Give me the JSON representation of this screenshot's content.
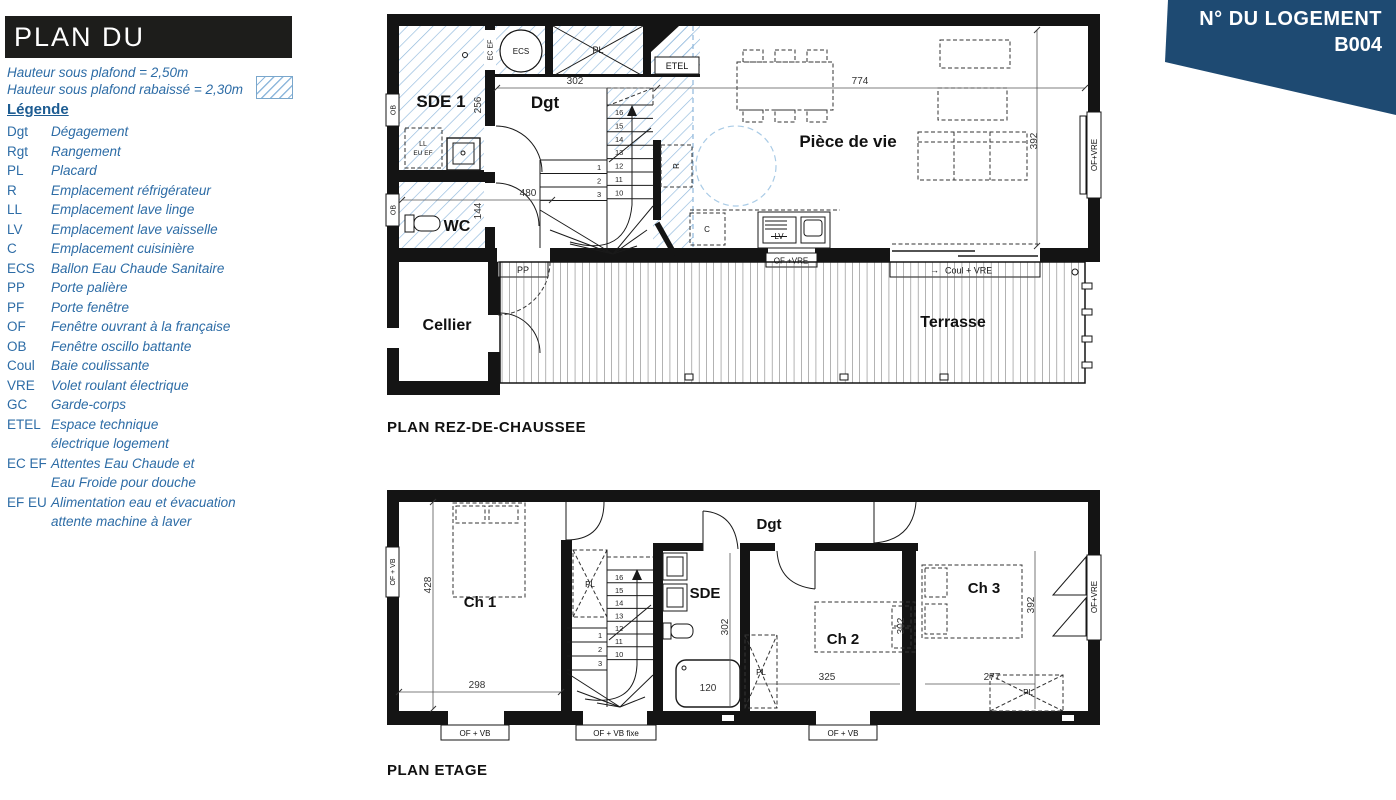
{
  "colors": {
    "accent_blue": "#2d6ca6",
    "badge_navy": "#1e4a72",
    "hatch_blue": "#8fb8dc",
    "wall_black": "#141414"
  },
  "header": {
    "title": "PLAN DU LOGEMENT",
    "ceiling_note_1": "Hauteur sous plafond = 2,50m",
    "ceiling_note_2": "Hauteur sous plafond rabaissé = 2,30m",
    "legend_title": "Légende",
    "legend": [
      {
        "abbr": "Dgt",
        "label": "Dégagement"
      },
      {
        "abbr": "Rgt",
        "label": "Rangement"
      },
      {
        "abbr": "PL",
        "label": "Placard"
      },
      {
        "abbr": "R",
        "label": "Emplacement réfrigérateur"
      },
      {
        "abbr": "LL",
        "label": "Emplacement lave linge"
      },
      {
        "abbr": "LV",
        "label": "Emplacement lave vaisselle"
      },
      {
        "abbr": "C",
        "label": "Emplacement cuisinière"
      },
      {
        "abbr": "ECS",
        "label": "Ballon Eau Chaude Sanitaire"
      },
      {
        "abbr": "PP",
        "label": "Porte palière"
      },
      {
        "abbr": "PF",
        "label": "Porte fenêtre"
      },
      {
        "abbr": "OF",
        "label": "Fenêtre ouvrant à la française"
      },
      {
        "abbr": "OB",
        "label": "Fenêtre oscillo battante"
      },
      {
        "abbr": "Coul",
        "label": "Baie coulissante"
      },
      {
        "abbr": "VRE",
        "label": "Volet roulant électrique"
      },
      {
        "abbr": "GC",
        "label": "Garde-corps"
      },
      {
        "abbr": "ETEL",
        "label": "Espace technique",
        "label2": "électrique logement"
      },
      {
        "abbr": "EC EF",
        "label": "Attentes Eau Chaude et",
        "label2": "Eau Froide pour douche"
      },
      {
        "abbr": "EF EU",
        "label": "Alimentation eau et évacuation",
        "label2": "attente machine à laver"
      }
    ]
  },
  "badge": {
    "line1": "N° DU LOGEMENT",
    "line2": "B004"
  },
  "rdc": {
    "caption": "PLAN REZ-DE-CHAUSSEE",
    "rooms": {
      "sde1": "SDE 1",
      "dgt": "Dgt",
      "wc": "WC",
      "piece": "Pièce de vie",
      "cellier": "Cellier",
      "terrasse": "Terrasse"
    },
    "labels": {
      "ecs": "ECS",
      "pl": "PL",
      "etel": "ETEL",
      "ecef": "EC EF",
      "ll": "LL",
      "euef": "EU EF",
      "r": "R",
      "c": "C",
      "lv": "LV",
      "pp": "PP",
      "ob": "OB",
      "of_vre_bottom": "OF +VRE",
      "coul_arrow": "→",
      "coul": "Coul + VRE",
      "of_vre_wall": "OF+VRE"
    },
    "dims": {
      "w_dgt": "302",
      "h_sde": "256",
      "w_wc": "480",
      "h_wc": "144",
      "w_piece": "774",
      "h_piece": "392"
    },
    "stairs_upper": [
      "16",
      "15",
      "14",
      "13",
      "12",
      "11",
      "10"
    ],
    "stairs_lower": [
      "1",
      "2",
      "3"
    ]
  },
  "etage": {
    "caption": "PLAN ETAGE",
    "rooms": {
      "ch1": "Ch 1",
      "ch2": "Ch 2",
      "ch3": "Ch 3",
      "sde": "SDE",
      "dgt": "Dgt"
    },
    "labels": {
      "pl": "PL",
      "of_vb": "OF + VB",
      "of_vb_fixe": "OF + VB fixe",
      "of_vre_wall": "OF+VRE"
    },
    "dims": {
      "ch1_h": "428",
      "ch1_w": "298",
      "sde_h": "302",
      "bath": "120",
      "bed": "302",
      "ch2_w": "325",
      "ch3_h": "392",
      "ch3_w": "277"
    },
    "stairs_upper": [
      "16",
      "15",
      "14",
      "13",
      "12",
      "11",
      "10"
    ],
    "stairs_lower": [
      "1",
      "2",
      "3"
    ]
  }
}
